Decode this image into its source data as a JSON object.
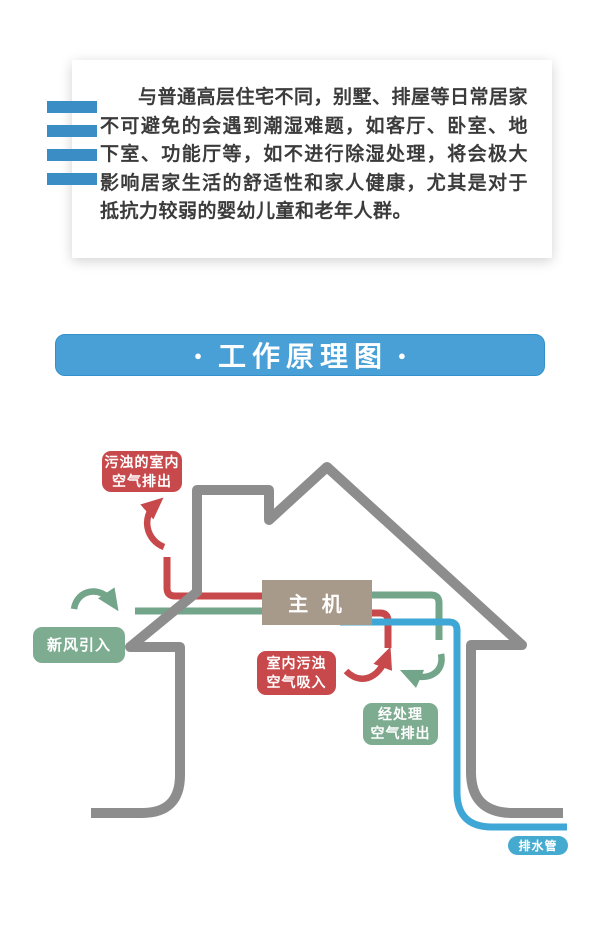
{
  "intro_card": {
    "text": "与普通高层住宅不同，别墅、排屋等日常居家不可避免的会遇到潮湿难题，如客厅、卧室、地下室、功能厅等，如不进行除湿处理，将会极大影响居家生活的舒适性和家人健康，尤其是对于抵抗力较弱的婴幼儿童和老年人群。",
    "accent_bar_color": "#3a8dc5"
  },
  "section_banner": {
    "title": "工作原理图",
    "bullet": "●",
    "background": "#48a0d7",
    "text_color": "#ffffff"
  },
  "diagram": {
    "labels": {
      "exhaust_top": {
        "lines": [
          "污浊的室内",
          "空气排出"
        ],
        "color": "#c8494c"
      },
      "fresh_air_in": {
        "lines": [
          "新风引入"
        ],
        "color": "#7dac91"
      },
      "indoor_intake": {
        "lines": [
          "室内污浊",
          "空气吸入"
        ],
        "color": "#c8494c"
      },
      "treated_out": {
        "lines": [
          "经处理",
          "空气排出"
        ],
        "color": "#7dac91"
      },
      "main_unit": {
        "label": "主 机",
        "color": "#a89a8a"
      },
      "drain_pipe": {
        "label": "排水管",
        "color": "#45aacf"
      }
    },
    "colors": {
      "house_outline": "#8d8d8d",
      "red_pipe": "#c8494c",
      "green_pipe": "#73a58a",
      "blue_pipe": "#3fa7d6"
    }
  }
}
